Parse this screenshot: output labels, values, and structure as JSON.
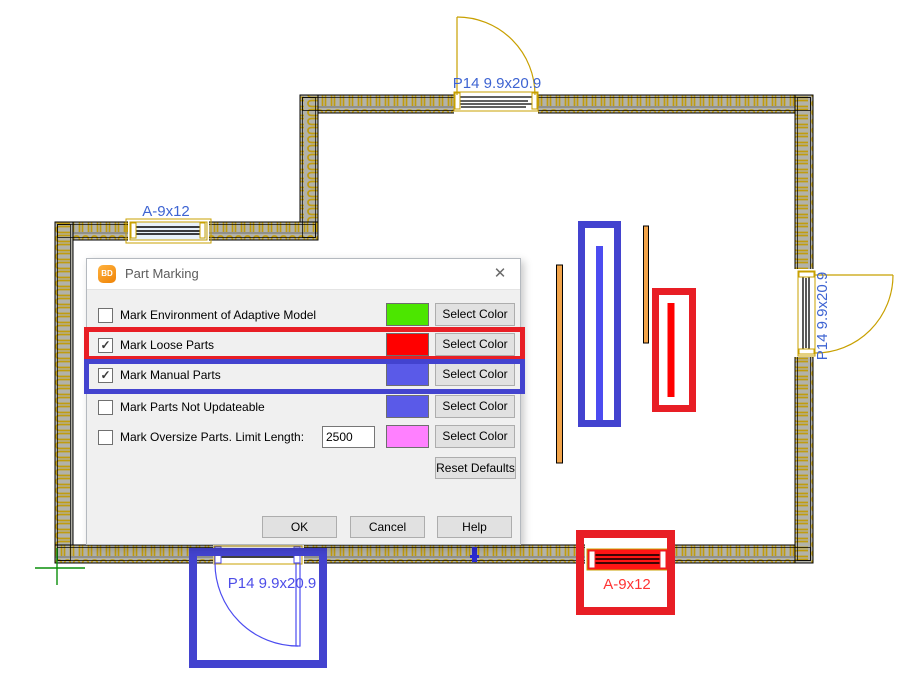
{
  "plan": {
    "labels": {
      "top_door": "P14 9.9x20.9",
      "left_window": "A-9x12",
      "right_door": "P14 9.9x20.9",
      "bottom_door": "P14 9.9x20.9",
      "bottom_window": "A-9x12",
      "section_marker": "FB"
    },
    "colors": {
      "wall_hatch": "#c09c10",
      "wall_bg": "#b2b2aa",
      "door_frame": "#c8a000",
      "label_blue": "#3e64d2",
      "label_marked_blue": "#4d4de8",
      "label_marked_red": "#ff3333",
      "mark_red": "#e81e25",
      "mark_blue": "#4343cf",
      "part_red": "#ff0000",
      "part_blue": "#4c4cf0",
      "orange_part": "#f2a44a",
      "origin_green": "#0a8f0a"
    }
  },
  "dialog": {
    "title": "Part Marking",
    "icon_text": "BD",
    "close_glyph": "✕",
    "rows": [
      {
        "label": "Mark Environment of Adaptive Model",
        "check_glyph": "",
        "swatch_color": "#4ce600",
        "button_label": "Select Color"
      },
      {
        "label": "Mark Loose Parts",
        "check_glyph": "✓",
        "swatch_color": "#ff0000",
        "button_label": "Select Color"
      },
      {
        "label": "Mark Manual Parts",
        "check_glyph": "✓",
        "swatch_color": "#5a5ae8",
        "button_label": "Select Color"
      },
      {
        "label": "Mark Parts Not Updateable",
        "check_glyph": "",
        "swatch_color": "#5a5ae8",
        "button_label": "Select Color"
      },
      {
        "label": "Mark Oversize Parts. Limit Length:",
        "check_glyph": "",
        "swatch_color": "#ff80ff",
        "button_label": "Select Color",
        "input_value": "2500"
      }
    ],
    "reset_label": "Reset Defaults",
    "buttons": {
      "ok": "OK",
      "cancel": "Cancel",
      "help": "Help"
    }
  }
}
